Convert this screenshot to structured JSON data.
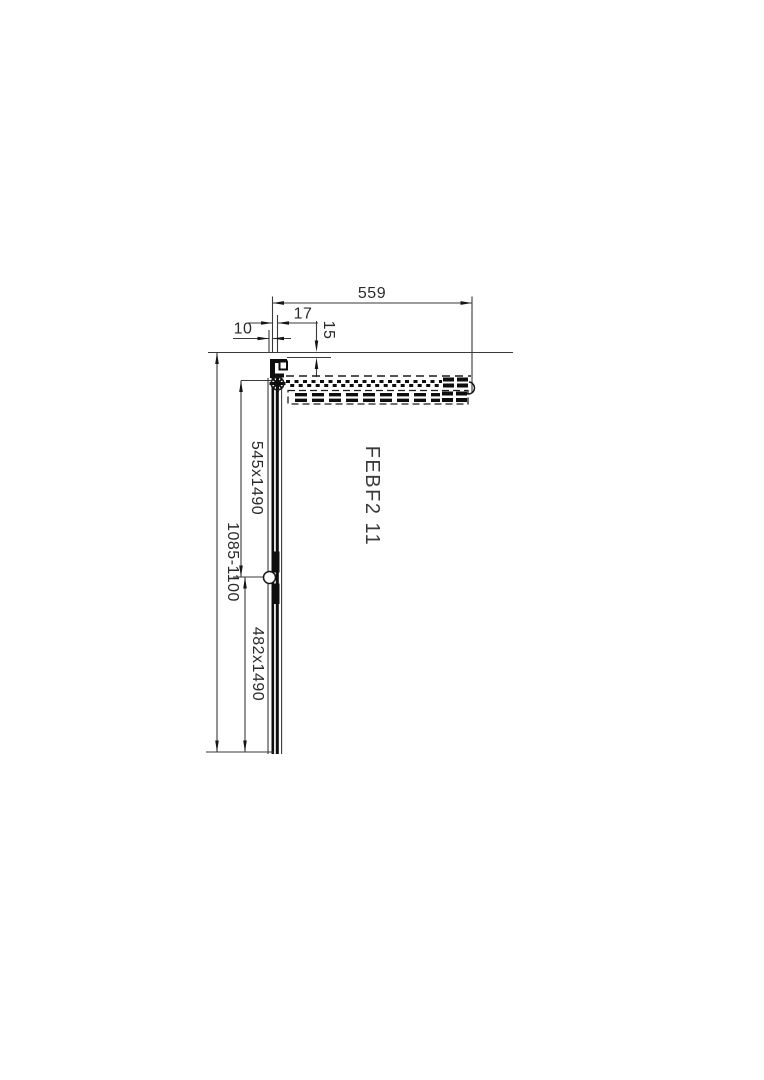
{
  "drawing": {
    "product_label": "FEBF2 11",
    "dims": {
      "top_width": "559",
      "pivot_offset": "17",
      "drop_offset": "15",
      "glass_offset": "10",
      "upper_panel": "545x1490",
      "overall_height": "1085-1100",
      "lower_panel": "482x1490"
    }
  }
}
